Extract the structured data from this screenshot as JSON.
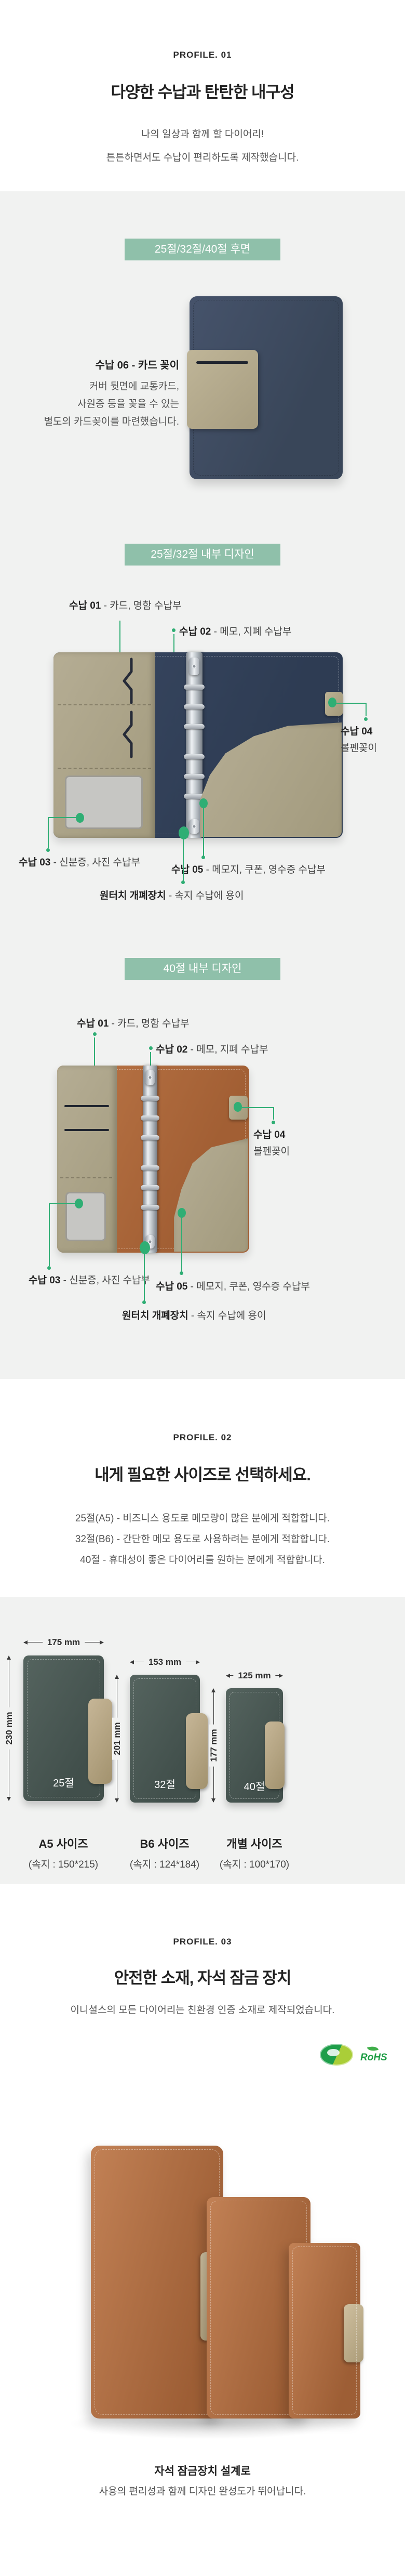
{
  "profile01": {
    "eyebrow": "PROFILE. 01",
    "title": "다양한 수납과 탄탄한 내구성",
    "sub1": "나의 일상과 함께 할 다이어리!",
    "sub2": "튼튼하면서도 수납이 편리하도록 제작했습니다.",
    "badge_back": "25절/32절/40절 후면",
    "badge_interior_ab": "25절/32절 내부 디자인",
    "badge_interior_40": "40절 내부 디자인",
    "pocket_title": "수납 06 - 카드 꽂이",
    "pocket_line1": "커버 뒷면에 교통카드,",
    "pocket_line2": "사원증 등을 꽂을 수 있는",
    "pocket_line3": "별도의 카드꽂이를 마련했습니다."
  },
  "callouts": {
    "c01_label": "수납 01",
    "c01_desc": " - 카드, 명함 수납부",
    "c02_label": "수납 02",
    "c02_desc": " - 메모, 지폐 수납부",
    "c03_label": "수납 03",
    "c03_desc": " - 신분증, 사진 수납부",
    "c04_label": "수납 04",
    "c04_desc": "볼펜꽂이",
    "c05_label": "수납 05",
    "c05_desc": " - 메모지, 쿠폰, 영수증 수납부",
    "onetouch_label": "원터치 개폐장치",
    "onetouch_desc": " - 속지 수납에 용이"
  },
  "profile02": {
    "eyebrow": "PROFILE. 02",
    "title": "내게 필요한 사이즈로 선택하세요.",
    "line1": "25절(A5) - 비즈니스 용도로 메모량이 많은 분에게 적합합니다.",
    "line2": "32절(B6) - 간단한 메모 용도로 사용하려는 분에게 적합합니다.",
    "line3": "40절 - 휴대성이 좋은 다이어리를 원하는 분에게 적합합니다.",
    "sizes": [
      {
        "cover_badge": "25절",
        "name": "A5 사이즈",
        "inner": "(속지 : 150*215)",
        "width": "175 mm",
        "height": "230 mm"
      },
      {
        "cover_badge": "32절",
        "name": "B6 사이즈",
        "inner": "(속지 : 124*184)",
        "width": "153 mm",
        "height": "201 mm"
      },
      {
        "cover_badge": "40절",
        "name": "개별 사이즈",
        "inner": "(속지 : 100*170)",
        "width": "125 mm",
        "height": "177 mm"
      }
    ]
  },
  "profile03": {
    "eyebrow": "PROFILE. 03",
    "title": "안전한 소재, 자석 잠금 장치",
    "desc": "이니셜스의 모든 다이어리는 친환경 인증 소재로 제작되었습니다.",
    "rohs": "RoHS",
    "caption1": "자석 잠금장치 설계로",
    "caption2": "사용의 편리성과 함께 디자인 완성도가 뛰어납니다."
  }
}
